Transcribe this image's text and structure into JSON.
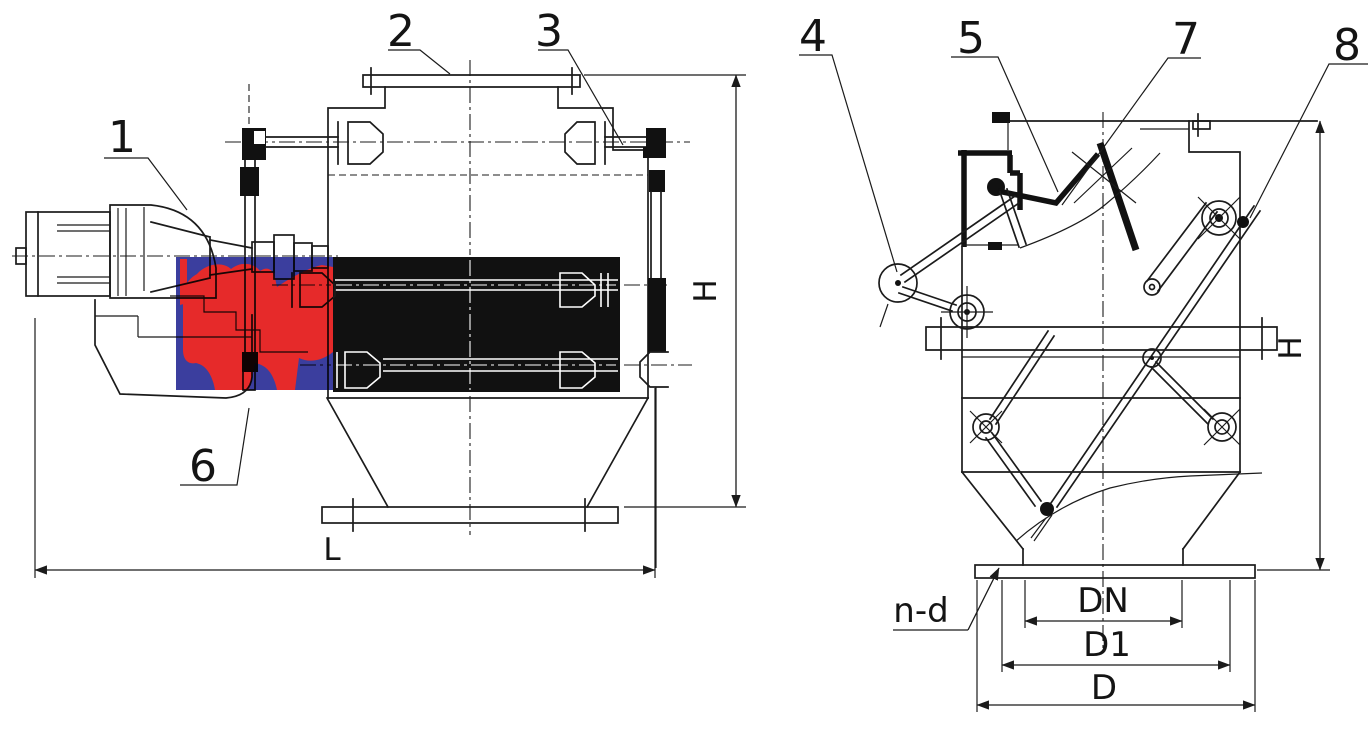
{
  "drawing": {
    "background": "#ffffff",
    "line_color": "#1b1b1b",
    "highlight": {
      "blue": "#3b3e9e",
      "red": "#e62a2a"
    },
    "left_view": {
      "callouts": {
        "c1": "1",
        "c2": "2",
        "c3": "3",
        "c6": "6"
      },
      "dims": {
        "length": "L",
        "height": "H"
      }
    },
    "right_view": {
      "callouts": {
        "c4": "4",
        "c5": "5",
        "c7": "7",
        "c8": "8"
      },
      "dims": {
        "height": "H",
        "outlet_bore": "DN",
        "bolt_circle": "D1",
        "flange_diameter": "D",
        "bolt_holes": "n-d"
      }
    }
  }
}
